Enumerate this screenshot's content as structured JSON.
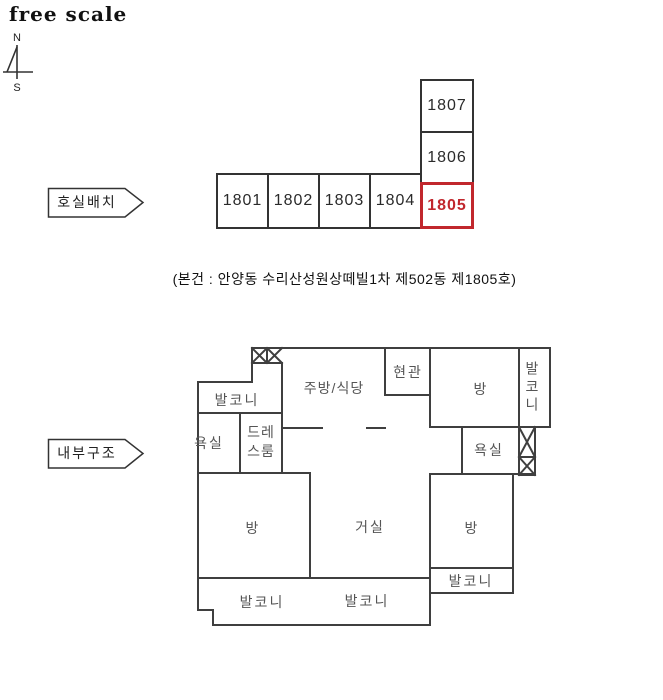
{
  "header": {
    "scale_label": "free scale"
  },
  "compass": {
    "north_label": "N",
    "south_label": "S"
  },
  "unit_layout": {
    "section_label": "호실배치",
    "units": [
      "1801",
      "1802",
      "1803",
      "1804"
    ],
    "stacked_units": [
      "1807",
      "1806"
    ],
    "highlighted_unit": "1805"
  },
  "caption": "(본건 : 안양동 수리산성원상떼빌1차 제502동 제1805호)",
  "floor_plan": {
    "section_label": "내부구조",
    "rooms": {
      "balcony_top_left": "발코니",
      "bathroom_left": "욕실",
      "dress_room": "드레스룸",
      "kitchen_dining": "주방/식당",
      "entrance": "현관",
      "room_top_right": "방",
      "balcony_right": "발코니",
      "bathroom_right": "욕실",
      "room_left": "방",
      "living_room": "거실",
      "room_bottom_right": "방",
      "balcony_mid_right": "발코니",
      "balcony_bottom_left": "발코니",
      "balcony_bottom_middle": "발코니"
    }
  },
  "colors": {
    "wall": "#3f3f3f",
    "highlight": "#c1272d",
    "room_label": "#555555"
  }
}
